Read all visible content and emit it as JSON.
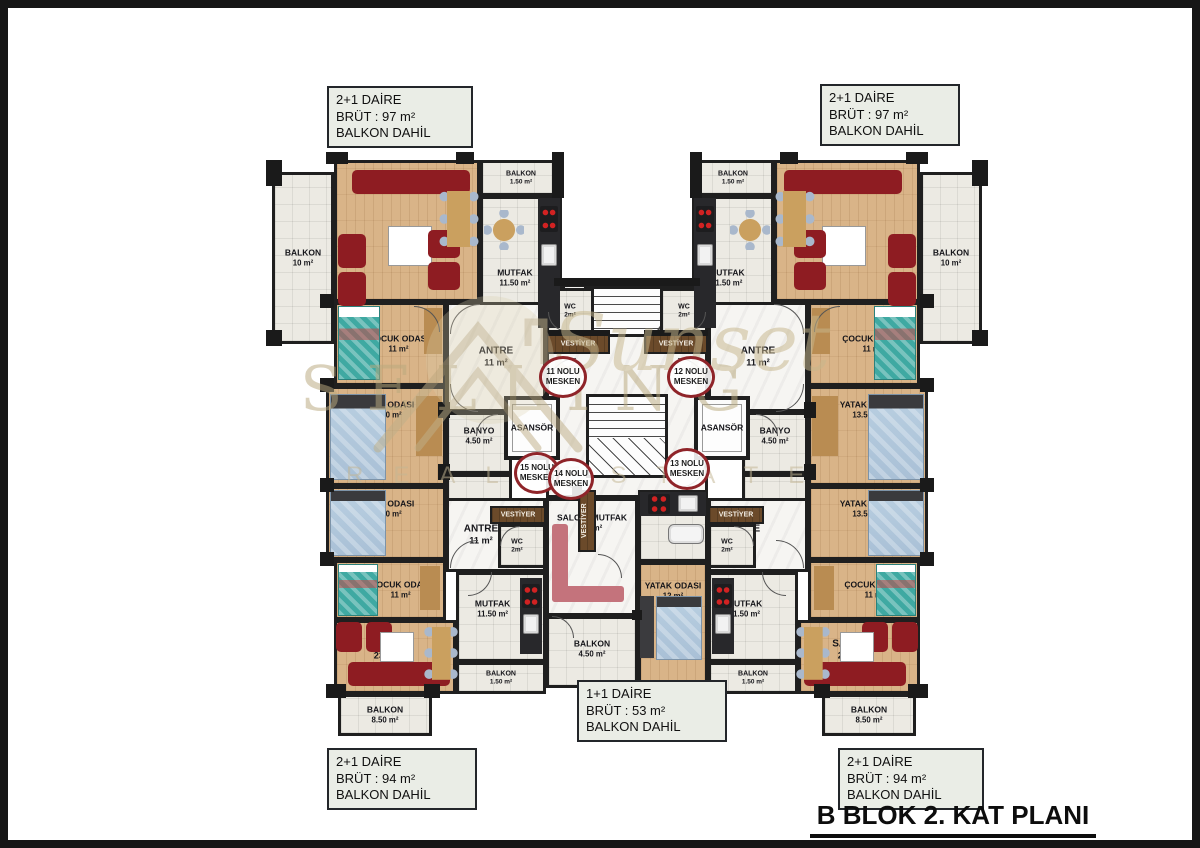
{
  "title": {
    "text": "B BLOK 2. KAT PLANI"
  },
  "unit_boxes": {
    "top_left": {
      "lines": [
        "2+1 DAİRE",
        "BRÜT : 97 m²",
        "BALKON DAHİL"
      ]
    },
    "top_right": {
      "lines": [
        "2+1 DAİRE",
        "BRÜT : 97 m²",
        "BALKON DAHİL"
      ]
    },
    "bottom_left": {
      "lines": [
        "2+1 DAİRE",
        "BRÜT : 94 m²",
        "BALKON DAHİL"
      ]
    },
    "bottom_right": {
      "lines": [
        "2+1 DAİRE",
        "BRÜT : 94 m²",
        "BALKON DAHİL"
      ]
    },
    "bottom_center": {
      "lines": [
        "1+1 DAİRE",
        "BRÜT : 53 m²",
        "BALKON DAHİL"
      ]
    }
  },
  "watermark": {
    "line1": "SELLING",
    "line2": "Sunset",
    "line3": "REAL ESTATE"
  },
  "colors": {
    "wall": "#1f1f1f",
    "wood_floor": "#d9b488",
    "tile_floor": "#eceae3",
    "marble_floor": "#f6f5f2",
    "sofa_red": "#8e1c22",
    "bed_teal": "#3fa9a2",
    "bed_blue": "#b9cfe1",
    "sofa_pink": "#c4737c",
    "counter": "#28282b",
    "stove_burner": "#d22222",
    "mesken_circle": "#8f2429",
    "label_box_bg": "#eaede6",
    "vestiyer_wood": "#6b4a2a"
  },
  "plan": {
    "mirror_axis_x": 627,
    "rooms": [
      {
        "n": "void-top",
        "f": "out",
        "x": 562,
        "y": 160,
        "w": 130,
        "h": 124
      },
      {
        "n": "corridor-top",
        "f": "marble",
        "x": 562,
        "y": 284,
        "w": 130,
        "h": 110
      },
      {
        "n": "stairs-top",
        "f": "stairsh",
        "x": 584,
        "y": 286,
        "w": 106,
        "h": 66
      },
      {
        "n": "corridor-mid",
        "f": "marble",
        "x": 546,
        "y": 334,
        "w": 162,
        "h": 164
      },
      {
        "n": "stairs-mid",
        "f": "stairsm",
        "x": 586,
        "y": 394,
        "w": 82,
        "h": 84
      },
      {
        "n": "balkon-10",
        "a": "BALKON",
        "b": "10 m²",
        "f": "tile",
        "x": 272,
        "y": 172,
        "w": 62,
        "h": 172,
        "m": 1,
        "sz": "sm"
      },
      {
        "n": "salon-top",
        "a": "SALON",
        "b": "23 m²",
        "f": "wood",
        "x": 334,
        "y": 160,
        "w": 146,
        "h": 142,
        "m": 1,
        "ly": 66
      },
      {
        "n": "balkon-150-top",
        "a": "BALKON",
        "b": "1.50 m²",
        "f": "tile",
        "x": 480,
        "y": 160,
        "w": 82,
        "h": 36,
        "m": 1,
        "sz": "xs"
      },
      {
        "n": "mutfak-top",
        "a": "MUTFAK",
        "b": "11.50 m²",
        "f": "tile",
        "x": 480,
        "y": 196,
        "w": 82,
        "h": 134,
        "m": 1,
        "ly": 62,
        "lx": 42,
        "sz": "sm"
      },
      {
        "n": "cocuk-top",
        "a": "ÇOCUK ODASI",
        "b": "11 m²",
        "f": "wood",
        "x": 334,
        "y": 302,
        "w": 112,
        "h": 84,
        "m": 1,
        "lx": 58,
        "sz": "sm"
      },
      {
        "n": "antre-top",
        "a": "ANTRE",
        "b": "11 m²",
        "f": "marble",
        "x": 446,
        "y": 302,
        "w": 100,
        "h": 110,
        "m": 1
      },
      {
        "n": "wc-top",
        "a": "WC",
        "b": "2m²",
        "f": "tile",
        "x": 546,
        "y": 288,
        "w": 48,
        "h": 46,
        "m": 1,
        "sz": "xs"
      },
      {
        "n": "vestiyer-top",
        "a": "VESTİYER",
        "f": "dark",
        "x": 546,
        "y": 334,
        "w": 64,
        "h": 20,
        "m": 1,
        "sz": "xs",
        "light": 1
      },
      {
        "n": "yatak-top",
        "a": "YATAK ODASI",
        "b": "13.50 m²",
        "f": "wood",
        "x": 326,
        "y": 386,
        "w": 120,
        "h": 100,
        "m": 1,
        "ly": 22,
        "sz": "sm"
      },
      {
        "n": "banyo-1",
        "a": "BANYO",
        "b": "4.50 m²",
        "f": "tile",
        "x": 446,
        "y": 412,
        "w": 66,
        "h": 62,
        "m": 1,
        "sz": "sm",
        "ly": 38
      },
      {
        "n": "banyo-2",
        "a": "BANYO",
        "b": "4.50 m²",
        "f": "tile",
        "x": 446,
        "y": 474,
        "w": 66,
        "h": 62,
        "m": 1,
        "sz": "sm",
        "ly": 55
      },
      {
        "n": "asansor",
        "a": "ASANSÖR",
        "f": "elev",
        "x": 504,
        "y": 396,
        "w": 56,
        "h": 64,
        "m": 1,
        "sz": "sm"
      },
      {
        "n": "yatak-bot",
        "a": "YATAK ODASI",
        "b": "13.50 m²",
        "f": "wood",
        "x": 326,
        "y": 486,
        "w": 120,
        "h": 74,
        "m": 1,
        "ly": 30,
        "sz": "sm"
      },
      {
        "n": "cocuk-bot",
        "a": "ÇOCUK ODASI",
        "b": "11 m²",
        "f": "wood",
        "x": 334,
        "y": 560,
        "w": 112,
        "h": 60,
        "m": 1,
        "lx": 60,
        "sz": "sm"
      },
      {
        "n": "antre-bot",
        "a": "ANTRE",
        "b": "11 m²",
        "f": "marble",
        "x": 446,
        "y": 498,
        "w": 100,
        "h": 74,
        "m": 1,
        "lx": 34
      },
      {
        "n": "vestiyer-bot",
        "a": "VESTİYER",
        "f": "dark",
        "x": 490,
        "y": 506,
        "w": 56,
        "h": 18,
        "m": 1,
        "sz": "xs",
        "light": 1
      },
      {
        "n": "wc-bot",
        "a": "WC",
        "b": "2m²",
        "f": "tile",
        "x": 498,
        "y": 524,
        "w": 48,
        "h": 44,
        "m": 1,
        "sz": "xs",
        "lx": 38
      },
      {
        "n": "salon-bot",
        "a": "SALON",
        "b": "23 m²",
        "f": "wood",
        "x": 334,
        "y": 620,
        "w": 122,
        "h": 74,
        "m": 1,
        "lx": 42,
        "ly": 40
      },
      {
        "n": "mutfak-bot",
        "a": "MUTFAK",
        "b": "11.50 m²",
        "f": "tile",
        "x": 456,
        "y": 572,
        "w": 90,
        "h": 90,
        "m": 1,
        "lx": 40,
        "ly": 40,
        "sz": "sm"
      },
      {
        "n": "balkon-150-bot",
        "a": "BALKON",
        "b": "1.50 m²",
        "f": "tile",
        "x": 456,
        "y": 662,
        "w": 90,
        "h": 32,
        "m": 1,
        "sz": "xs"
      },
      {
        "n": "balkon-850",
        "a": "BALKON",
        "b": "8.50 m²",
        "f": "tile",
        "x": 338,
        "y": 694,
        "w": 94,
        "h": 42,
        "m": 1,
        "sz": "sm"
      },
      {
        "n": "salon-mutfak",
        "a": "SALON+MUTFAK",
        "b": "21 m²",
        "f": "marble",
        "x": 546,
        "y": 498,
        "w": 92,
        "h": 118,
        "ly": 20,
        "sz": "sm"
      },
      {
        "n": "kitchen-nook",
        "f": "tile",
        "x": 638,
        "y": 490,
        "w": 70,
        "h": 72
      },
      {
        "n": "vestiyer-14",
        "a": "VESTİYER",
        "f": "dark",
        "x": 578,
        "y": 490,
        "w": 18,
        "h": 62,
        "sz": "xs",
        "vert": 1,
        "light": 1
      },
      {
        "n": "yatak-12",
        "a": "YATAK ODASI",
        "b": "12 m²",
        "f": "wood",
        "x": 638,
        "y": 562,
        "w": 70,
        "h": 126,
        "ly": 22,
        "sz": "sm"
      },
      {
        "n": "balkon-450",
        "a": "BALKON",
        "b": "4.50 m²",
        "f": "tile",
        "x": 546,
        "y": 616,
        "w": 92,
        "h": 72,
        "ly": 45,
        "sz": "sm"
      }
    ],
    "circles": [
      {
        "t": "11 NOLU",
        "b": "MESKEN",
        "x": 539,
        "y": 356,
        "w": 48,
        "h": 42
      },
      {
        "t": "12 NOLU",
        "b": "MESKEN",
        "x": 667,
        "y": 356,
        "w": 48,
        "h": 42
      },
      {
        "t": "15 NOLU",
        "b": "MESKEN",
        "x": 514,
        "y": 452,
        "w": 46,
        "h": 42
      },
      {
        "t": "14 NOLU",
        "b": "MESKEN",
        "x": 548,
        "y": 458,
        "w": 46,
        "h": 42
      },
      {
        "t": "13 NOLU",
        "b": "MESKEN",
        "x": 664,
        "y": 448,
        "w": 46,
        "h": 42
      }
    ],
    "piers": [
      {
        "x": 266,
        "y": 160,
        "w": 16,
        "h": 26,
        "m": 1
      },
      {
        "x": 326,
        "y": 152,
        "w": 22,
        "h": 12,
        "m": 1
      },
      {
        "x": 456,
        "y": 152,
        "w": 18,
        "h": 12,
        "m": 1
      },
      {
        "x": 552,
        "y": 152,
        "w": 12,
        "h": 46,
        "m": 1
      },
      {
        "x": 266,
        "y": 330,
        "w": 16,
        "h": 16,
        "m": 1
      },
      {
        "x": 320,
        "y": 294,
        "w": 14,
        "h": 14,
        "m": 1
      },
      {
        "x": 320,
        "y": 378,
        "w": 14,
        "h": 14,
        "m": 1
      },
      {
        "x": 438,
        "y": 402,
        "w": 12,
        "h": 16,
        "m": 1
      },
      {
        "x": 320,
        "y": 478,
        "w": 14,
        "h": 14,
        "m": 1
      },
      {
        "x": 438,
        "y": 464,
        "w": 12,
        "h": 16,
        "m": 1
      },
      {
        "x": 320,
        "y": 552,
        "w": 14,
        "h": 14,
        "m": 1
      },
      {
        "x": 326,
        "y": 684,
        "w": 20,
        "h": 14,
        "m": 1
      },
      {
        "x": 424,
        "y": 684,
        "w": 16,
        "h": 14,
        "m": 1
      },
      {
        "x": 546,
        "y": 330,
        "w": 64,
        "h": 6,
        "m": 1
      },
      {
        "x": 554,
        "y": 278,
        "w": 146,
        "h": 8,
        "m": 0
      },
      {
        "x": 572,
        "y": 486,
        "w": 10,
        "h": 10,
        "m": 0
      },
      {
        "x": 632,
        "y": 610,
        "w": 10,
        "h": 10,
        "m": 0
      }
    ],
    "doors": [
      {
        "x": 450,
        "y": 304,
        "r": 30,
        "c": "tl",
        "m": 1
      },
      {
        "x": 414,
        "y": 306,
        "r": 26,
        "c": "tr",
        "m": 1
      },
      {
        "x": 450,
        "y": 384,
        "r": 28,
        "c": "bl",
        "m": 1
      },
      {
        "x": 476,
        "y": 414,
        "r": 22,
        "c": "tl",
        "m": 1
      },
      {
        "x": 548,
        "y": 312,
        "r": 20,
        "c": "bl",
        "m": 1
      },
      {
        "x": 548,
        "y": 358,
        "r": 28,
        "c": "tl",
        "m": 1
      },
      {
        "x": 548,
        "y": 460,
        "r": 28,
        "c": "bl",
        "m": 1
      },
      {
        "x": 450,
        "y": 540,
        "r": 28,
        "c": "tl",
        "m": 1
      },
      {
        "x": 468,
        "y": 572,
        "r": 24,
        "c": "br",
        "m": 1
      },
      {
        "x": 500,
        "y": 526,
        "r": 20,
        "c": "tl",
        "m": 1
      },
      {
        "x": 598,
        "y": 554,
        "r": 24,
        "c": "tr",
        "m": 0
      },
      {
        "x": 552,
        "y": 616,
        "r": 22,
        "c": "tr",
        "m": 0
      }
    ],
    "furniture": [
      {
        "t": "rect",
        "x": 352,
        "y": 170,
        "w": 118,
        "h": 24,
        "c": "#8e1c22",
        "r": 5,
        "m": 1
      },
      {
        "t": "rect",
        "x": 338,
        "y": 234,
        "w": 28,
        "h": 34,
        "c": "#8e1c22",
        "r": 5,
        "m": 1
      },
      {
        "t": "rect",
        "x": 338,
        "y": 272,
        "w": 28,
        "h": 34,
        "c": "#8e1c22",
        "r": 5,
        "m": 1
      },
      {
        "t": "rect",
        "x": 388,
        "y": 226,
        "w": 44,
        "h": 40,
        "c": "#ffffff",
        "bd": 1,
        "m": 1
      },
      {
        "t": "rect",
        "x": 428,
        "y": 230,
        "w": 32,
        "h": 28,
        "c": "#8e1c22",
        "r": 5,
        "m": 1
      },
      {
        "t": "rect",
        "x": 428,
        "y": 262,
        "w": 32,
        "h": 28,
        "c": "#8e1c22",
        "r": 5,
        "m": 1
      },
      {
        "t": "dining",
        "x": 438,
        "y": 184,
        "w": 42,
        "h": 70,
        "m": 1
      },
      {
        "t": "rect",
        "x": 538,
        "y": 198,
        "w": 22,
        "h": 130,
        "c": "#28282b",
        "m": 1
      },
      {
        "t": "stove",
        "x": 540,
        "y": 206,
        "w": 18,
        "h": 26,
        "m": 1
      },
      {
        "t": "sink",
        "x": 541,
        "y": 244,
        "w": 16,
        "h": 22,
        "m": 1
      },
      {
        "t": "rtable",
        "x": 484,
        "y": 210,
        "w": 40,
        "h": 40,
        "m": 1
      },
      {
        "t": "bedteal",
        "x": 338,
        "y": 306,
        "w": 42,
        "h": 74,
        "m": 1
      },
      {
        "t": "rect",
        "x": 424,
        "y": 308,
        "w": 18,
        "h": 46,
        "c": "#b98c52",
        "m": 1
      },
      {
        "t": "bedblue",
        "x": 330,
        "y": 394,
        "w": 56,
        "h": 86,
        "m": 1
      },
      {
        "t": "rect",
        "x": 416,
        "y": 396,
        "w": 26,
        "h": 60,
        "c": "#b98c52",
        "m": 1
      },
      {
        "t": "bedblue",
        "x": 330,
        "y": 490,
        "w": 56,
        "h": 66,
        "m": 1
      },
      {
        "t": "bedteal",
        "x": 338,
        "y": 564,
        "w": 40,
        "h": 52,
        "m": 1
      },
      {
        "t": "rect",
        "x": 420,
        "y": 566,
        "w": 20,
        "h": 44,
        "c": "#b98c52",
        "m": 1
      },
      {
        "t": "rect",
        "x": 348,
        "y": 662,
        "w": 102,
        "h": 24,
        "c": "#8e1c22",
        "r": 5,
        "m": 1
      },
      {
        "t": "rect",
        "x": 336,
        "y": 622,
        "w": 26,
        "h": 30,
        "c": "#8e1c22",
        "r": 5,
        "m": 1
      },
      {
        "t": "rect",
        "x": 366,
        "y": 622,
        "w": 26,
        "h": 30,
        "c": "#8e1c22",
        "r": 5,
        "m": 1
      },
      {
        "t": "rect",
        "x": 380,
        "y": 632,
        "w": 34,
        "h": 30,
        "c": "#ffffff",
        "bd": 1,
        "m": 1
      },
      {
        "t": "dining",
        "x": 424,
        "y": 620,
        "w": 34,
        "h": 66,
        "m": 1
      },
      {
        "t": "rect",
        "x": 520,
        "y": 578,
        "w": 22,
        "h": 76,
        "c": "#28282b",
        "m": 1
      },
      {
        "t": "stove",
        "x": 522,
        "y": 584,
        "w": 18,
        "h": 24,
        "m": 1
      },
      {
        "t": "sink",
        "x": 523,
        "y": 614,
        "w": 16,
        "h": 20,
        "m": 1
      },
      {
        "t": "rect",
        "x": 552,
        "y": 524,
        "w": 16,
        "h": 78,
        "c": "#c4737c",
        "r": 3
      },
      {
        "t": "rect",
        "x": 552,
        "y": 586,
        "w": 72,
        "h": 16,
        "c": "#c4737c",
        "r": 3
      },
      {
        "t": "rect",
        "x": 640,
        "y": 492,
        "w": 66,
        "h": 24,
        "c": "#28282b"
      },
      {
        "t": "stove",
        "x": 648,
        "y": 494,
        "w": 22,
        "h": 20
      },
      {
        "t": "sink",
        "x": 678,
        "y": 495,
        "w": 20,
        "h": 17
      },
      {
        "t": "tub",
        "x": 668,
        "y": 524,
        "w": 36,
        "h": 20
      },
      {
        "t": "rect",
        "x": 640,
        "y": 596,
        "w": 14,
        "h": 62,
        "c": "#3b3b3e"
      },
      {
        "t": "bedblue",
        "x": 656,
        "y": 596,
        "w": 46,
        "h": 64
      }
    ]
  }
}
